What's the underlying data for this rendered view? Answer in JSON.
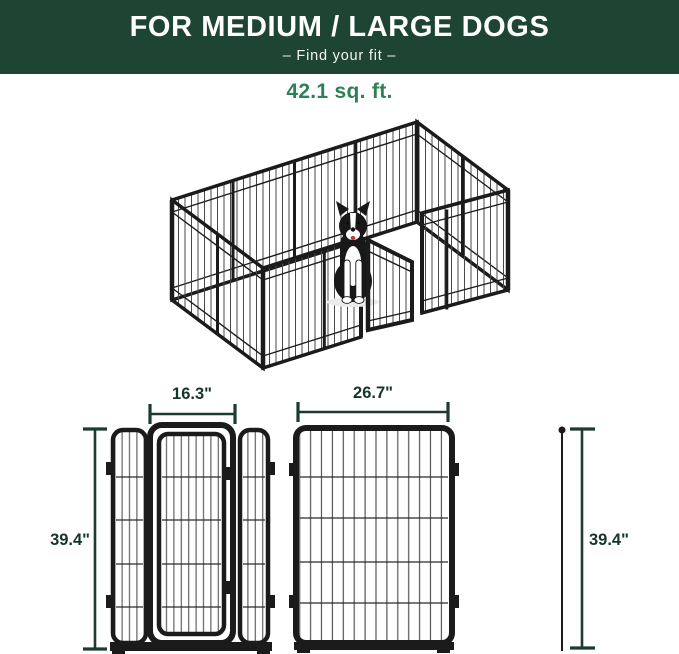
{
  "banner": {
    "title": "FOR MEDIUM / LARGE DOGS",
    "subtitle": "–  Find your fit  –"
  },
  "area": {
    "label": "42.1 sq. ft."
  },
  "illustration": {
    "name": "isometric-metal-dog-playpen-with-open-gate-and-border-collie"
  },
  "diagram": {
    "door_panel_width_label": "16.3\"",
    "wide_panel_width_label": "26.7\"",
    "left_height_label": "39.4\"",
    "right_height_label": "39.4\""
  },
  "colors": {
    "banner_bg": "#1e4433",
    "accent_green": "#2e8156",
    "dimension_line": "#1d3b32",
    "panel_black": "#1b1b1b"
  }
}
